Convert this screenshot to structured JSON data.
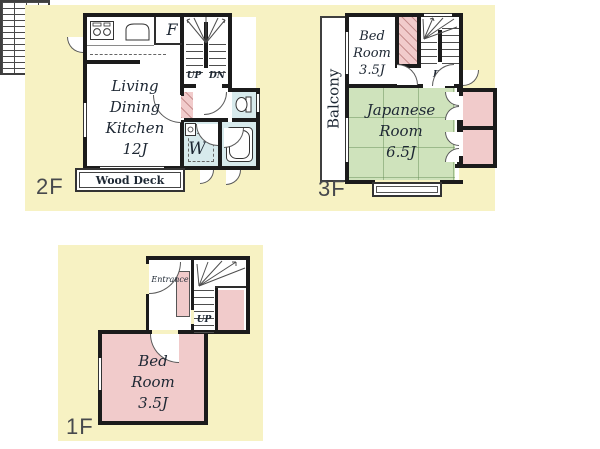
{
  "palette": {
    "panel": "#f7f2c3",
    "wall": "#1b1b1b",
    "pink": "#f1cbcb",
    "green": "#cfe3bc",
    "blue": "#d7eaec",
    "ink": "#1d2733",
    "floorink": "#47494d"
  },
  "icons": [
    "stove-icon",
    "sink-icon",
    "toilet-icon",
    "bathtub-icon",
    "washing-machine-box",
    "stair-fan-icon",
    "door-arc"
  ],
  "floor_2f": {
    "label": "2F",
    "ldk_lines": [
      "Living",
      "Dining",
      "Kitchen",
      "12J"
    ],
    "wood_deck": "Wood Deck",
    "closet": "F",
    "up": "UP",
    "dn": "DN",
    "washroom": "W"
  },
  "floor_3f": {
    "label": "3F",
    "balcony": "Balcony",
    "bedroom_lines": [
      "Bed",
      "Room",
      "3.5J"
    ],
    "japanese_lines": [
      "Japanese",
      "Room",
      "6.5J"
    ],
    "dn": "DN"
  },
  "floor_1f": {
    "label": "1F",
    "entrance": "Entrance",
    "up": "UP",
    "bedroom_lines": [
      "Bed",
      "Room",
      "3.5J"
    ]
  }
}
